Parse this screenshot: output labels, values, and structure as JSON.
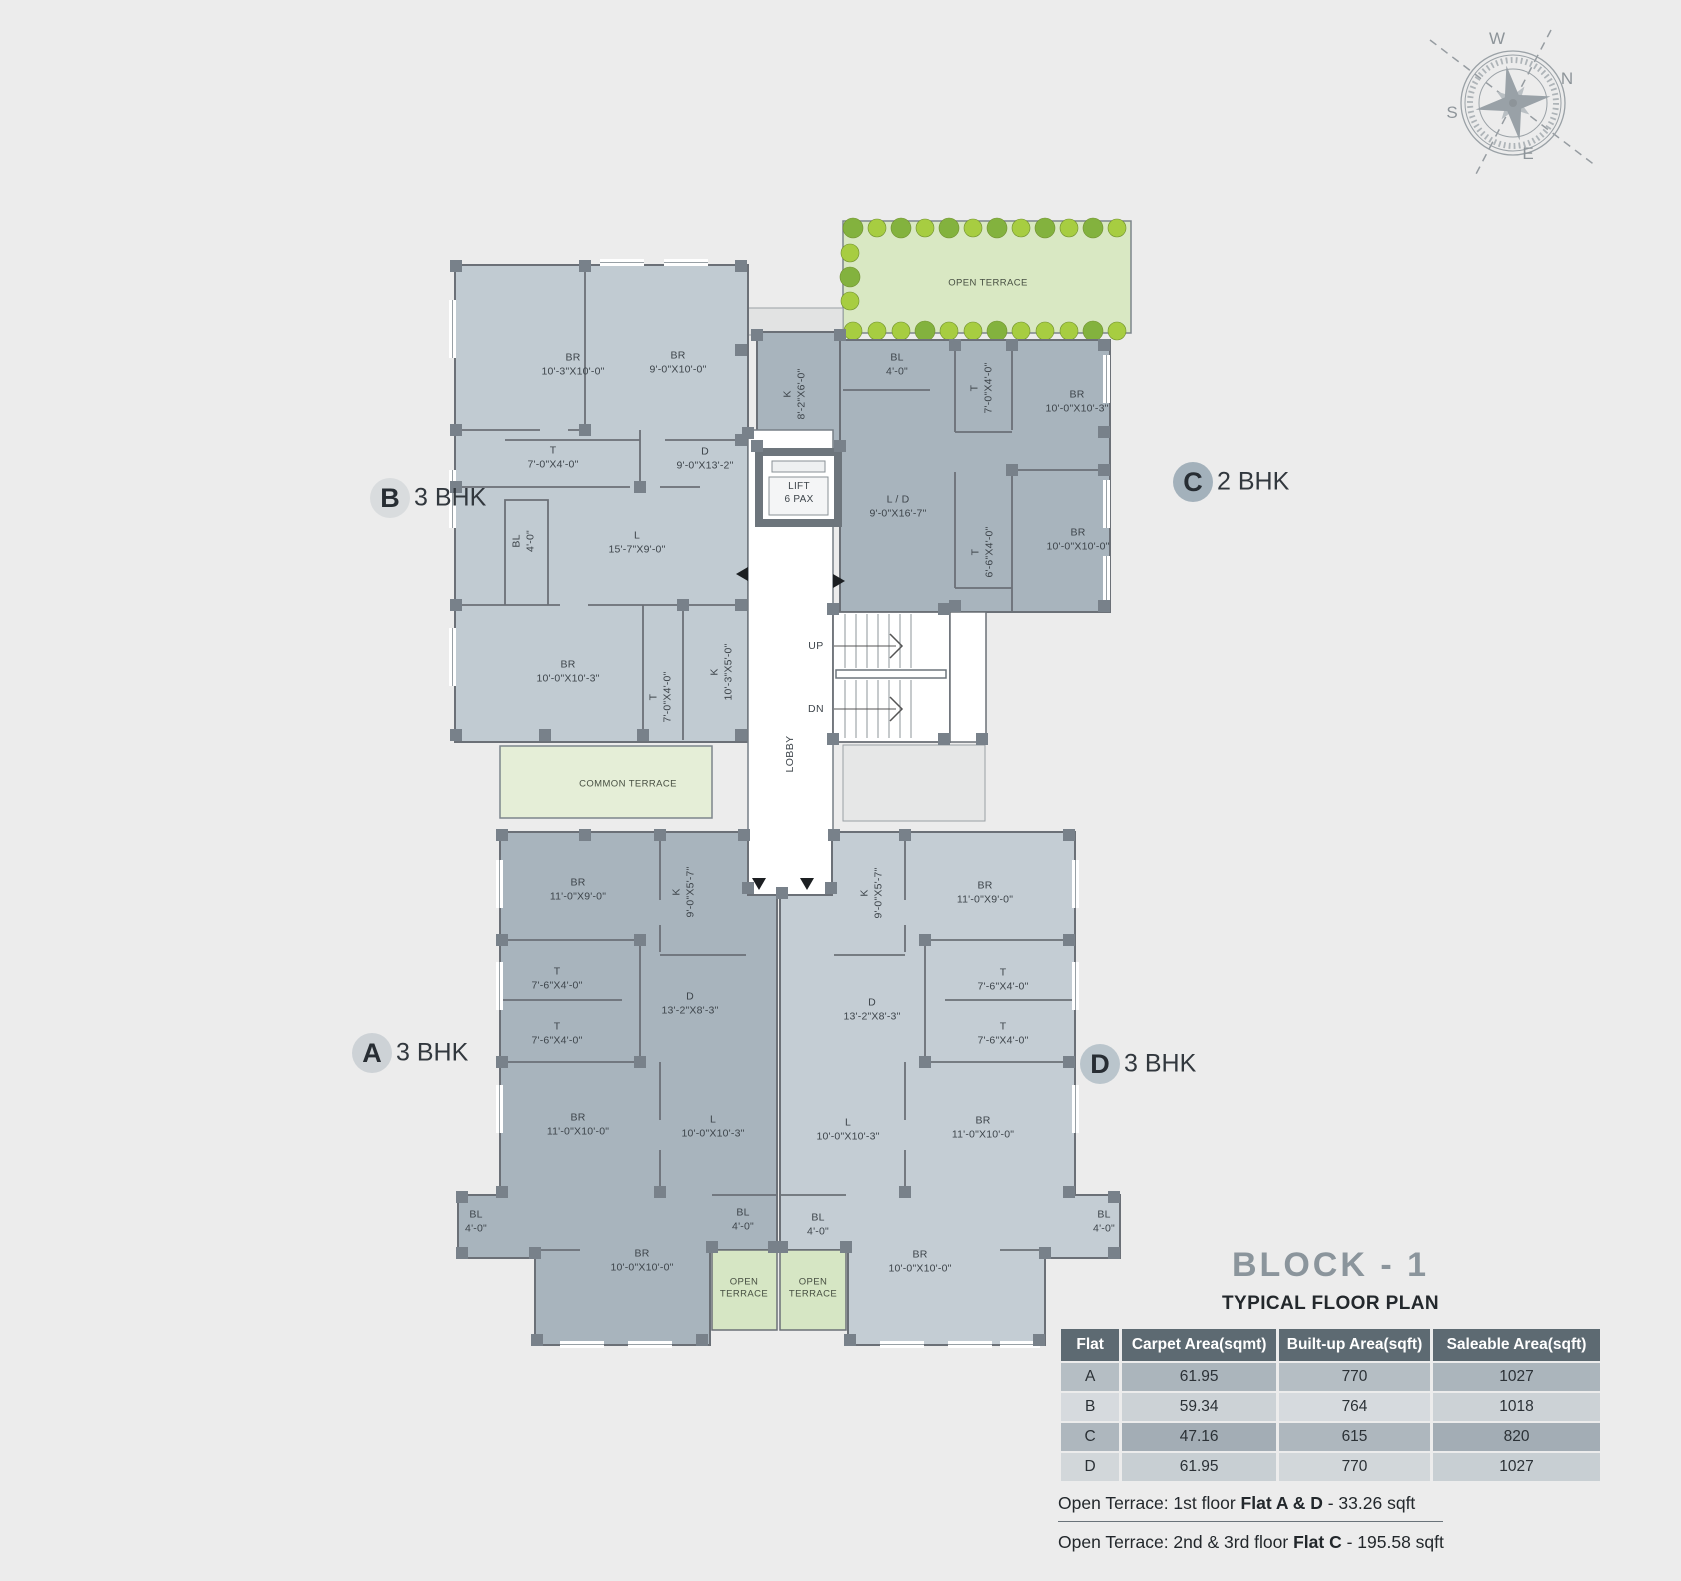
{
  "compass": {
    "n": "N",
    "s": "S",
    "e": "E",
    "w": "W"
  },
  "flats": [
    {
      "letter": "B",
      "type": "3 BHK"
    },
    {
      "letter": "C",
      "type": "2 BHK"
    },
    {
      "letter": "A",
      "type": "3 BHK"
    },
    {
      "letter": "D",
      "type": "3 BHK"
    }
  ],
  "core": {
    "lift1": "LIFT",
    "lift2": "6 PAX",
    "lobby": "LOBBY",
    "up": "UP",
    "dn": "DN"
  },
  "terraces": {
    "top": "OPEN TERRACE",
    "common": "COMMON TERRACE",
    "open1": "OPEN",
    "open2": "TERRACE"
  },
  "rooms": [
    {
      "name": "BR",
      "dims": "10'-3\"X10'-0\""
    },
    {
      "name": "BR",
      "dims": "9'-0\"X10'-0\""
    },
    {
      "name": "T",
      "dims": "7'-0\"X4'-0\""
    },
    {
      "name": "D",
      "dims": "9'-0\"X13'-2\""
    },
    {
      "name": "BL",
      "dims": "4'-0\""
    },
    {
      "name": "L",
      "dims": "15'-7\"X9'-0\""
    },
    {
      "name": "BR",
      "dims": "10'-0\"X10'-3\""
    },
    {
      "name": "T",
      "dims": "7'-0\"X4'-0\""
    },
    {
      "name": "K",
      "dims": "10'-3\"X5'-0\""
    },
    {
      "name": "K",
      "dims": "8'-2\"X6'-0\""
    },
    {
      "name": "BL",
      "dims": "4'-0\""
    },
    {
      "name": "T",
      "dims": "7'-0\"X4'-0\""
    },
    {
      "name": "BR",
      "dims": "10'-0\"X10'-3\""
    },
    {
      "name": "L / D",
      "dims": "9'-0\"X16'-7\""
    },
    {
      "name": "T",
      "dims": "6'-6\"X4'-0\""
    },
    {
      "name": "BR",
      "dims": "10'-0\"X10'-0\""
    },
    {
      "name": "BR",
      "dims": "11'-0\"X9'-0\""
    },
    {
      "name": "K",
      "dims": "9'-0\"X5'-7\""
    },
    {
      "name": "T",
      "dims": "7'-6\"X4'-0\""
    },
    {
      "name": "T",
      "dims": "7'-6\"X4'-0\""
    },
    {
      "name": "D",
      "dims": "13'-2\"X8'-3\""
    },
    {
      "name": "BR",
      "dims": "11'-0\"X10'-0\""
    },
    {
      "name": "L",
      "dims": "10'-0\"X10'-3\""
    },
    {
      "name": "BL",
      "dims": "4'-0\""
    },
    {
      "name": "BL",
      "dims": "4'-0\""
    },
    {
      "name": "BR",
      "dims": "10'-0\"X10'-0\""
    },
    {
      "name": "K",
      "dims": "9'-0\"X5'-7\""
    },
    {
      "name": "BR",
      "dims": "11'-0\"X9'-0\""
    },
    {
      "name": "T",
      "dims": "7'-6\"X4'-0\""
    },
    {
      "name": "T",
      "dims": "7'-6\"X4'-0\""
    },
    {
      "name": "D",
      "dims": "13'-2\"X8'-3\""
    },
    {
      "name": "BR",
      "dims": "11'-0\"X10'-0\""
    },
    {
      "name": "L",
      "dims": "10'-0\"X10'-3\""
    },
    {
      "name": "BL",
      "dims": "4'-0\""
    },
    {
      "name": "BL",
      "dims": "4'-0\""
    },
    {
      "name": "BR",
      "dims": "10'-0\"X10'-0\""
    }
  ],
  "title": {
    "block": "BLOCK - 1",
    "subtitle": "TYPICAL FLOOR PLAN"
  },
  "table": {
    "headers": [
      "Flat",
      "Carpet Area(sqmt)",
      "Built-up Area(sqft)",
      "Saleable Area(sqft)"
    ],
    "rows": [
      [
        "A",
        "61.95",
        "770",
        "1027"
      ],
      [
        "B",
        "59.34",
        "764",
        "1018"
      ],
      [
        "C",
        "47.16",
        "615",
        "820"
      ],
      [
        "D",
        "61.95",
        "770",
        "1027"
      ]
    ]
  },
  "notes": [
    {
      "pre": "Open Terrace: 1st floor ",
      "bold": "Flat A & D",
      "post": " - 33.26 sqft"
    },
    {
      "pre": "Open Terrace: 2nd & 3rd floor ",
      "bold": "Flat C",
      "post": " - 195.58 sqft"
    }
  ],
  "colors": {
    "flat_b": "#c1cbd2",
    "flat_c": "#a8b4bd",
    "flat_a": "#a8b4bd",
    "flat_d": "#c4cdd4",
    "terrace_green": "#d9e8c3",
    "common_terrace": "#e5eed7",
    "open_terrace_small": "#d6e6c4",
    "tree_bright": "#a7cd41",
    "tree_dark": "#83b23e",
    "table_header": "#5d6a72",
    "title_gray": "#8b959c",
    "wall": "#6b7077"
  }
}
